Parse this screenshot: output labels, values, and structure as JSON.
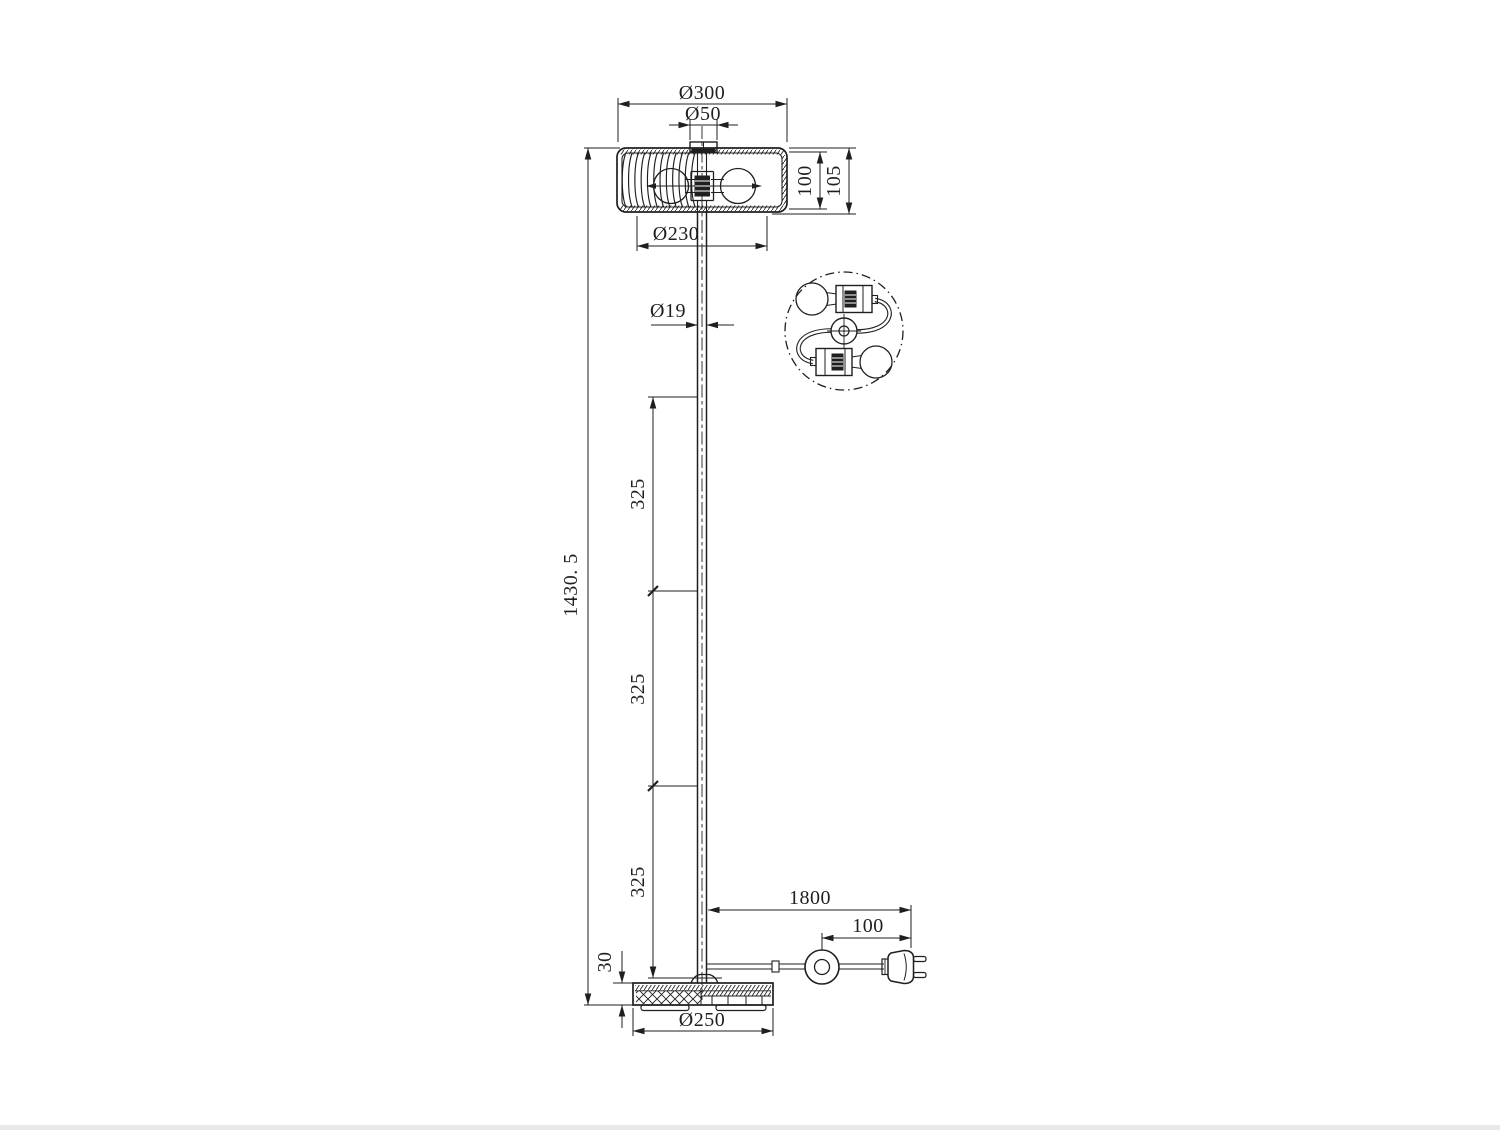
{
  "meta": {
    "background": "#ffffff",
    "ink": "#1f1f1f",
    "drawing_type": "floor lamp dimensional drawing",
    "units": "mm"
  },
  "dims": {
    "shade_outer_diameter": "Ø300",
    "top_cap_diameter": "Ø50",
    "shade_inner_height": "100",
    "shade_overall_height": "105",
    "shade_inner_diameter": "Ø230",
    "pole_diameter": "Ø19",
    "pole_segment_upper": "325",
    "pole_segment_middle": "325",
    "pole_segment_lower": "325",
    "overall_height": "1430. 5",
    "base_thickness": "30",
    "base_diameter": "Ø250",
    "cord_length": "1800",
    "switch_to_plug_length": "100"
  }
}
